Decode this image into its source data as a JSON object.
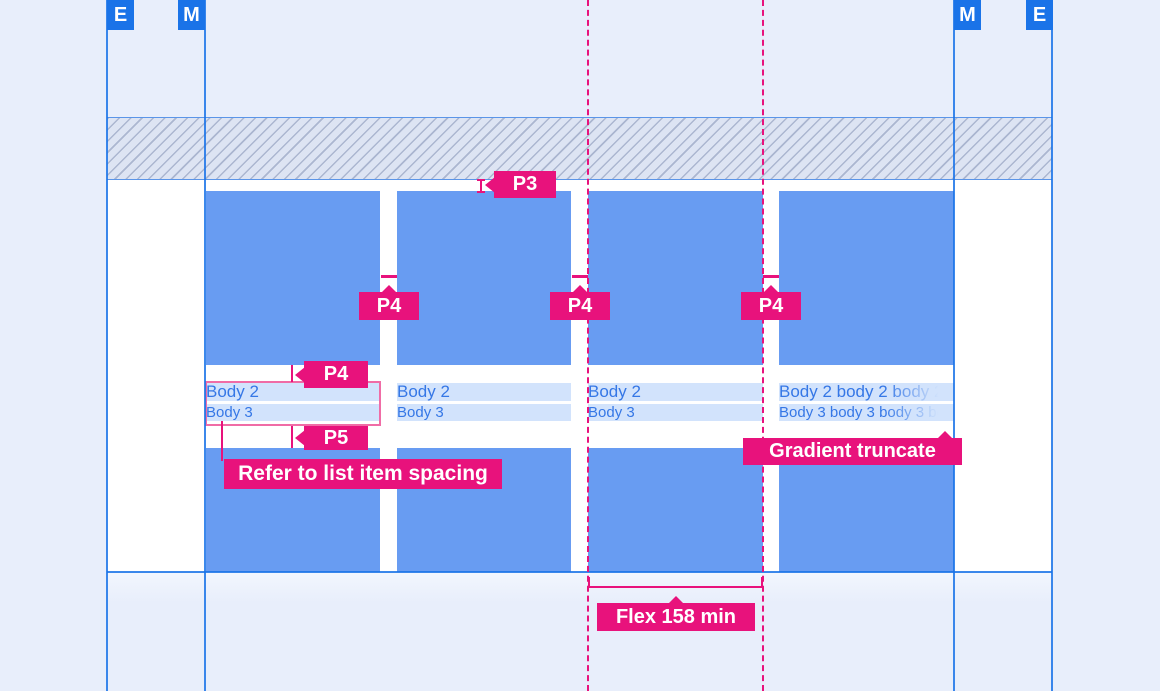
{
  "canvas": {
    "width": 1160,
    "height": 691
  },
  "colors": {
    "background": "#e8eefb",
    "keyline_blue": "#1a73e8",
    "card_fill": "#689cf2",
    "text_highlight": "#d2e3fc",
    "body_text_blue": "#3577e6",
    "annotation_pink": "#e8127c",
    "redline_box_pink": "#f06ca6",
    "content_white": "#ffffff"
  },
  "margin_guides": {
    "left_edge_label": "E",
    "left_margin_label": "M",
    "right_margin_label": "M",
    "right_edge_label": "E"
  },
  "cards": [
    {
      "line1": "Body 2",
      "line2": "Body 3"
    },
    {
      "line1": "Body 2",
      "line2": "Body 3"
    },
    {
      "line1": "Body 2",
      "line2": "Body 3"
    },
    {
      "line1": "Body 2 body 2 body 2 body 2",
      "line2": "Body 3 body 3 body 3 body 3"
    }
  ],
  "annotations": {
    "top_gap_chip": "P3",
    "gutter_chips": [
      "P4",
      "P4",
      "P4"
    ],
    "text_top_gap_chip": "P4",
    "text_bottom_gap_chip": "P5",
    "list_item_note": "Refer to list item spacing",
    "gradient_truncate_note": "Gradient truncate",
    "flex_column_note": "Flex 158 min"
  }
}
